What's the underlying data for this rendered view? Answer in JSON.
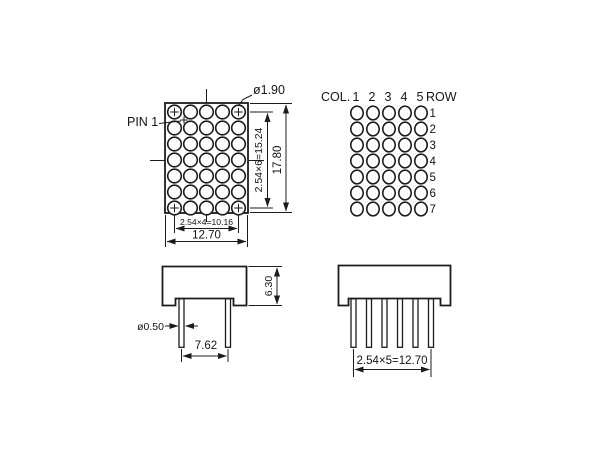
{
  "title": "5x7 LED dot matrix display mechanical drawing",
  "colors": {
    "line": "#1c1c1c",
    "background": "#ffffff"
  },
  "front_view": {
    "pin1_label": "PIN 1",
    "dot_diameter": "ø1.90",
    "col_pitch_dim": "2.54×4=10.16",
    "overall_width_dim": "12.70",
    "row_pitch_dim": "2.54×6=15.24",
    "overall_height_dim": "17.80",
    "columns": 5,
    "rows": 7
  },
  "pattern_view": {
    "col_header": "COL.",
    "row_header": "ROW",
    "col_labels": [
      "1",
      "2",
      "3",
      "4",
      "5"
    ],
    "row_labels": [
      "1",
      "2",
      "3",
      "4",
      "5",
      "6",
      "7"
    ]
  },
  "side_view": {
    "body_height_dim": "6.30",
    "pin_diameter": "ø0.50",
    "pin_pitch_dim": "7.62",
    "pins_visible": 2
  },
  "pin_row_view": {
    "pin_span_dim": "2.54×5=12.70",
    "pins_visible": 6
  }
}
